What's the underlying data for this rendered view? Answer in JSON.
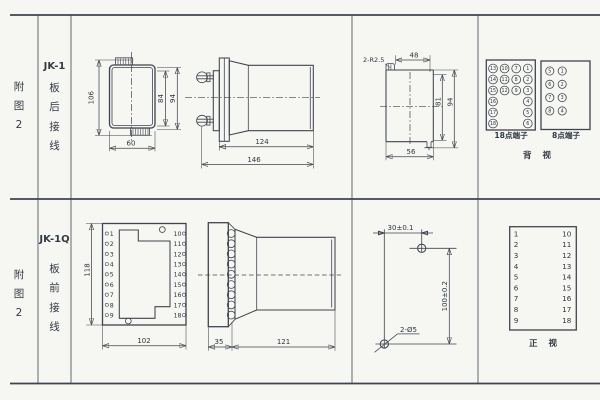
{
  "page": {
    "bg": "#f6f6f2",
    "line_color": "#3f454d",
    "text_color": "#2e3640"
  },
  "sidebar": {
    "top": {
      "fig": [
        "附",
        "图",
        "2"
      ],
      "model": "JK-1",
      "wiring": [
        "板",
        "后",
        "接",
        "线"
      ]
    },
    "bottom": {
      "fig": [
        "附",
        "图",
        "2"
      ],
      "model": "JK-1Q",
      "wiring": [
        "板",
        "前",
        "接",
        "线"
      ]
    }
  },
  "jk1_rear": {
    "dim_106": "106",
    "dim_84": "84",
    "dim_94": "94",
    "dim_60": "60"
  },
  "jk1_side": {
    "dim_124": "124",
    "dim_146": "146"
  },
  "cutout": {
    "radius": "2-R2.5",
    "dim_48": "48",
    "dim_81": "81",
    "dim_94": "94",
    "dim_56": "56"
  },
  "back_view": {
    "t18": {
      "label": "18点端子",
      "col1": [
        "13",
        "14",
        "15",
        "16",
        "17",
        "18"
      ],
      "col2": [
        "10",
        "11",
        "12"
      ],
      "col3": [
        "7",
        "8",
        "9"
      ],
      "col4": [
        "1",
        "2",
        "3",
        "4",
        "5",
        "6"
      ]
    },
    "t8": {
      "label": "8点端子",
      "left": [
        "5",
        "6",
        "7",
        "8"
      ],
      "right": [
        "1",
        "2",
        "3",
        "4"
      ]
    },
    "label": "背 视"
  },
  "jk1q_front": {
    "dim_118": "118",
    "dim_102": "102",
    "left": [
      "1",
      "2",
      "3",
      "4",
      "5",
      "6",
      "7",
      "8",
      "9"
    ],
    "right": [
      "10",
      "11",
      "12",
      "13",
      "14",
      "15",
      "16",
      "17",
      "18"
    ]
  },
  "jk1q_side": {
    "dim_35": "35",
    "dim_121": "121"
  },
  "drill": {
    "dim_30": "30±0.1",
    "dim_100": "100±0.2",
    "holes": "2-Ø5"
  },
  "front_table": {
    "left": [
      "1",
      "2",
      "3",
      "4",
      "5",
      "6",
      "7",
      "8",
      "9"
    ],
    "right": [
      "10",
      "11",
      "12",
      "13",
      "14",
      "15",
      "16",
      "17",
      "18"
    ],
    "label": "正 视"
  }
}
